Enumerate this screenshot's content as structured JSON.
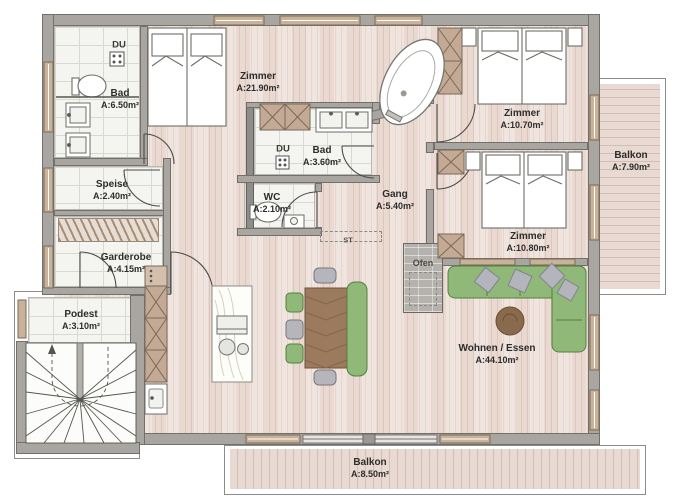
{
  "rooms": {
    "bad1": {
      "name": "Bad",
      "area": "A:6.50m²"
    },
    "zimmer1": {
      "name": "Zimmer",
      "area": "A:21.90m²"
    },
    "zimmer2": {
      "name": "Zimmer",
      "area": "A:10.70m²"
    },
    "zimmer3": {
      "name": "Zimmer",
      "area": "A:10.80m²"
    },
    "bad2": {
      "name": "Bad",
      "area": "A:3.60m²"
    },
    "wc": {
      "name": "WC",
      "area": "A:2.10m²"
    },
    "gang": {
      "name": "Gang",
      "area": "A:5.40m²"
    },
    "speise": {
      "name": "Speise",
      "area": "A:2.40m²"
    },
    "garderobe": {
      "name": "Garderobe",
      "area": "A:4.15m²"
    },
    "podest": {
      "name": "Podest",
      "area": "A:3.10m²"
    },
    "wohnen": {
      "name": "Wohnen / Essen",
      "area": "A:44.10m²"
    },
    "balkon1": {
      "name": "Balkon",
      "area": "A:7.90m²"
    },
    "balkon2": {
      "name": "Balkon",
      "area": "A:8.50m²"
    }
  },
  "annotations": {
    "du_bad1": "DU",
    "du_bad2": "DU",
    "ofen": "Ofen",
    "st": "ST"
  },
  "colors": {
    "wall": "#a9a6a2",
    "floor_wood": "#e9d9d1",
    "floor_stripe": "#dcc6bd",
    "tile": "#f4f4f1",
    "cabinet_wood": "#c4aa94",
    "furniture_green": "#8fb879",
    "table_wood": "#9b7a5d",
    "window_frame": "#c9b29a"
  }
}
